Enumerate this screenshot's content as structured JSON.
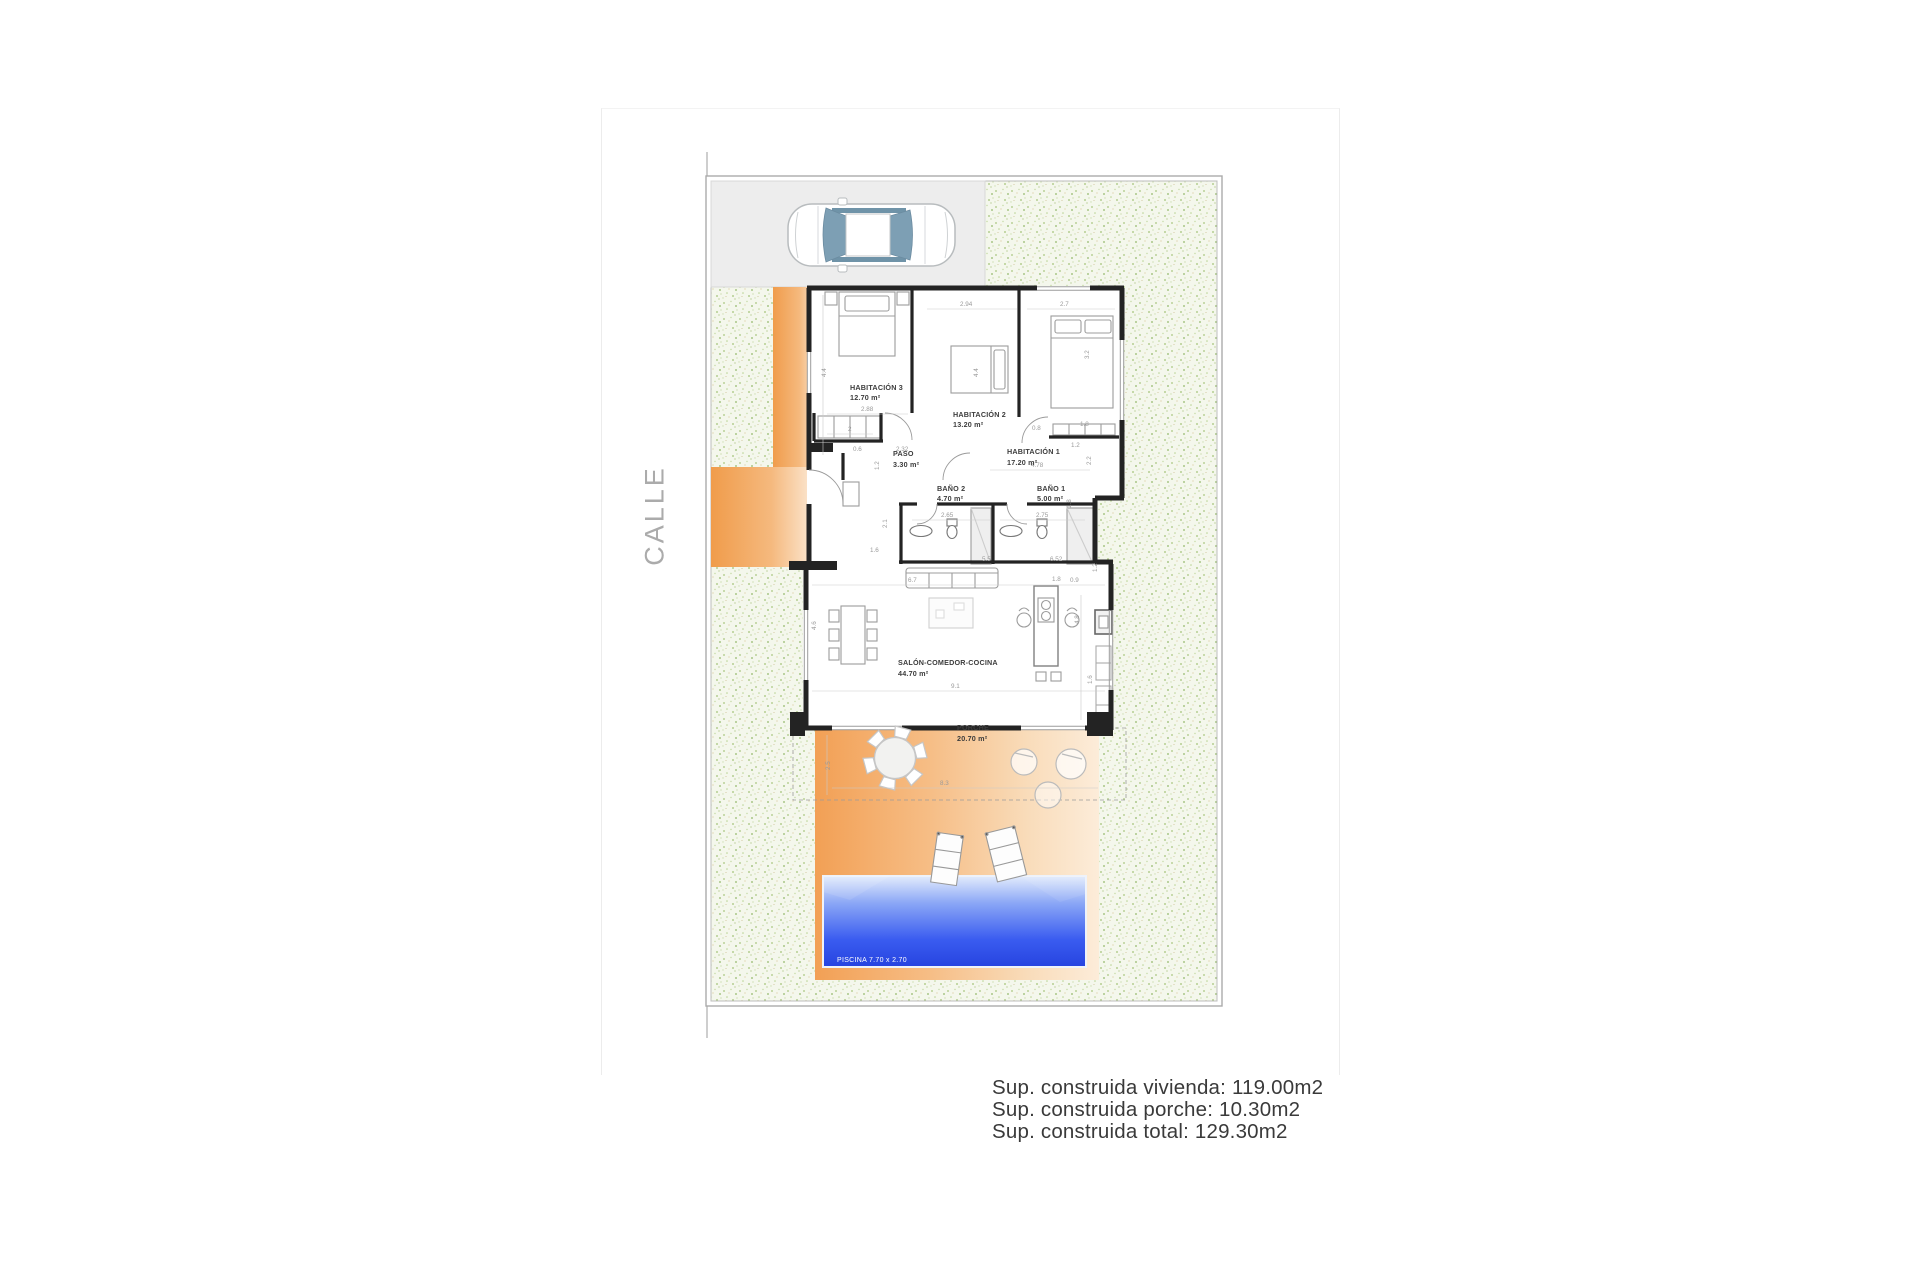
{
  "page": {
    "street_label": "CALLE",
    "summary": {
      "line1": "Sup. construida vivienda: 119.00m2",
      "line2": "Sup. construida porche: 10.30m2",
      "line3": "Sup. construida total: 129.30m2"
    }
  },
  "plan": {
    "rooms": [
      {
        "name": "HABITACIÓN 3",
        "area": "12.70 m²"
      },
      {
        "name": "HABITACIÓN 2",
        "area": "13.20 m²"
      },
      {
        "name": "HABITACIÓN 1",
        "area": "17.20 m²"
      },
      {
        "name": "PASO",
        "area": "3.30 m²"
      },
      {
        "name": "BAÑO 2",
        "area": "4.70 m²"
      },
      {
        "name": "BAÑO 1",
        "area": "5.00 m²"
      },
      {
        "name": "SALÓN-COMEDOR-COCINA",
        "area": "44.70 m²"
      },
      {
        "name": "PORCHE",
        "area": "20.70 m²"
      }
    ],
    "pool_label": "PISCINA 7.70 x 2.70",
    "dims": [
      "2.94",
      "2.7",
      "4.4",
      "4.4",
      "3.2",
      "2.88",
      "2",
      "0.8",
      "1.8",
      "1.2",
      "2.2",
      "2.32",
      "0.6",
      "1.2",
      "4.78",
      "1.8",
      "2.65",
      "2.75",
      "2.1",
      "1.6",
      "6.52",
      "1.2",
      "5.5",
      "6.7",
      "1.8",
      "0.9",
      "4.6",
      "4.8",
      "9.1",
      "1.6",
      "2.5",
      "8.3"
    ],
    "icons": [
      "car-top-view-icon",
      "pool",
      "porch-table-icon",
      "sun-lounger-icon",
      "bed-icon",
      "toilet-icon",
      "sink-icon",
      "dining-table-icon",
      "sofa-icon",
      "kitchen-island-icon"
    ],
    "colors": {
      "terrace_orange": "#f2a055",
      "pool_blue": "#2f55ea",
      "garden_dot_green": "#a9c67e",
      "driveway_gray": "#ededed",
      "wall_black": "#232323"
    }
  }
}
